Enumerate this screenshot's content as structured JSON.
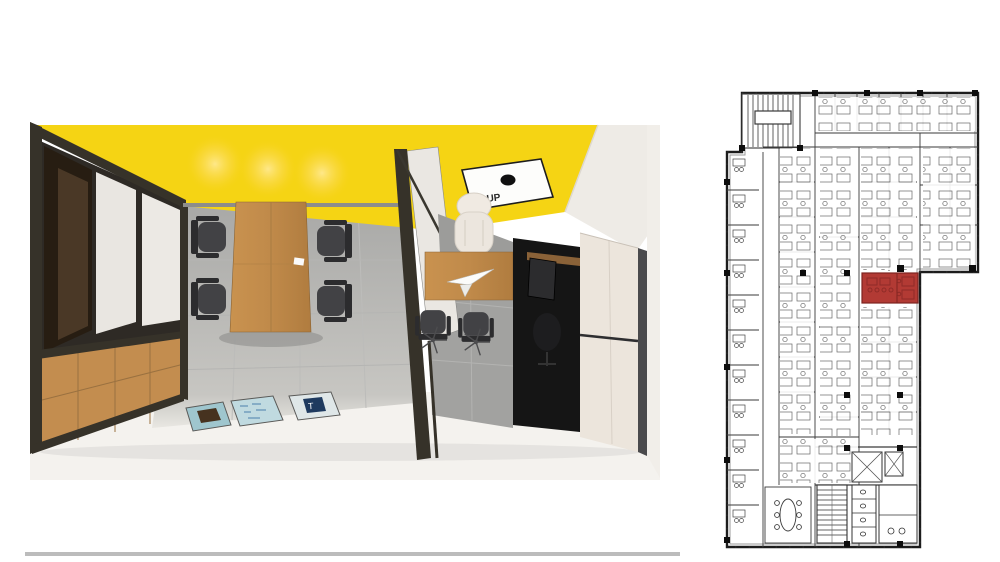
{
  "colors": {
    "highlight-red": "#b23a34",
    "highlight-red-dark": "#8f2b27",
    "ceiling-yellow": "#f5d414",
    "wood": "#c38d4f",
    "wood-dark": "#9a7140",
    "frame-dark": "#363229",
    "floor-gray": "#a9a9a7",
    "floor-white": "#f4f2ee",
    "wall-cream": "#ece5dc",
    "tv-black": "#151515",
    "chair-dark": "#3e3e41",
    "plan-line": "#2e2e2e",
    "plan-line-light": "#8a8a8a"
  },
  "render": {
    "ceiling_sign": {
      "label": "UP"
    },
    "posters": [
      {
        "name": "poster-emblem",
        "bg": "#9fc6ce",
        "motif_color": "#46321f",
        "letter": ""
      },
      {
        "name": "poster-map",
        "bg": "#c0dae0",
        "motif_color": "#4b80ad",
        "letter": ""
      },
      {
        "name": "poster-monogram",
        "bg": "#dfe7e8",
        "motif_color": "#1e3a5f",
        "letter": "T"
      }
    ]
  },
  "floor_plan": {
    "highlighted_room": {
      "name": "highlighted-room"
    }
  }
}
